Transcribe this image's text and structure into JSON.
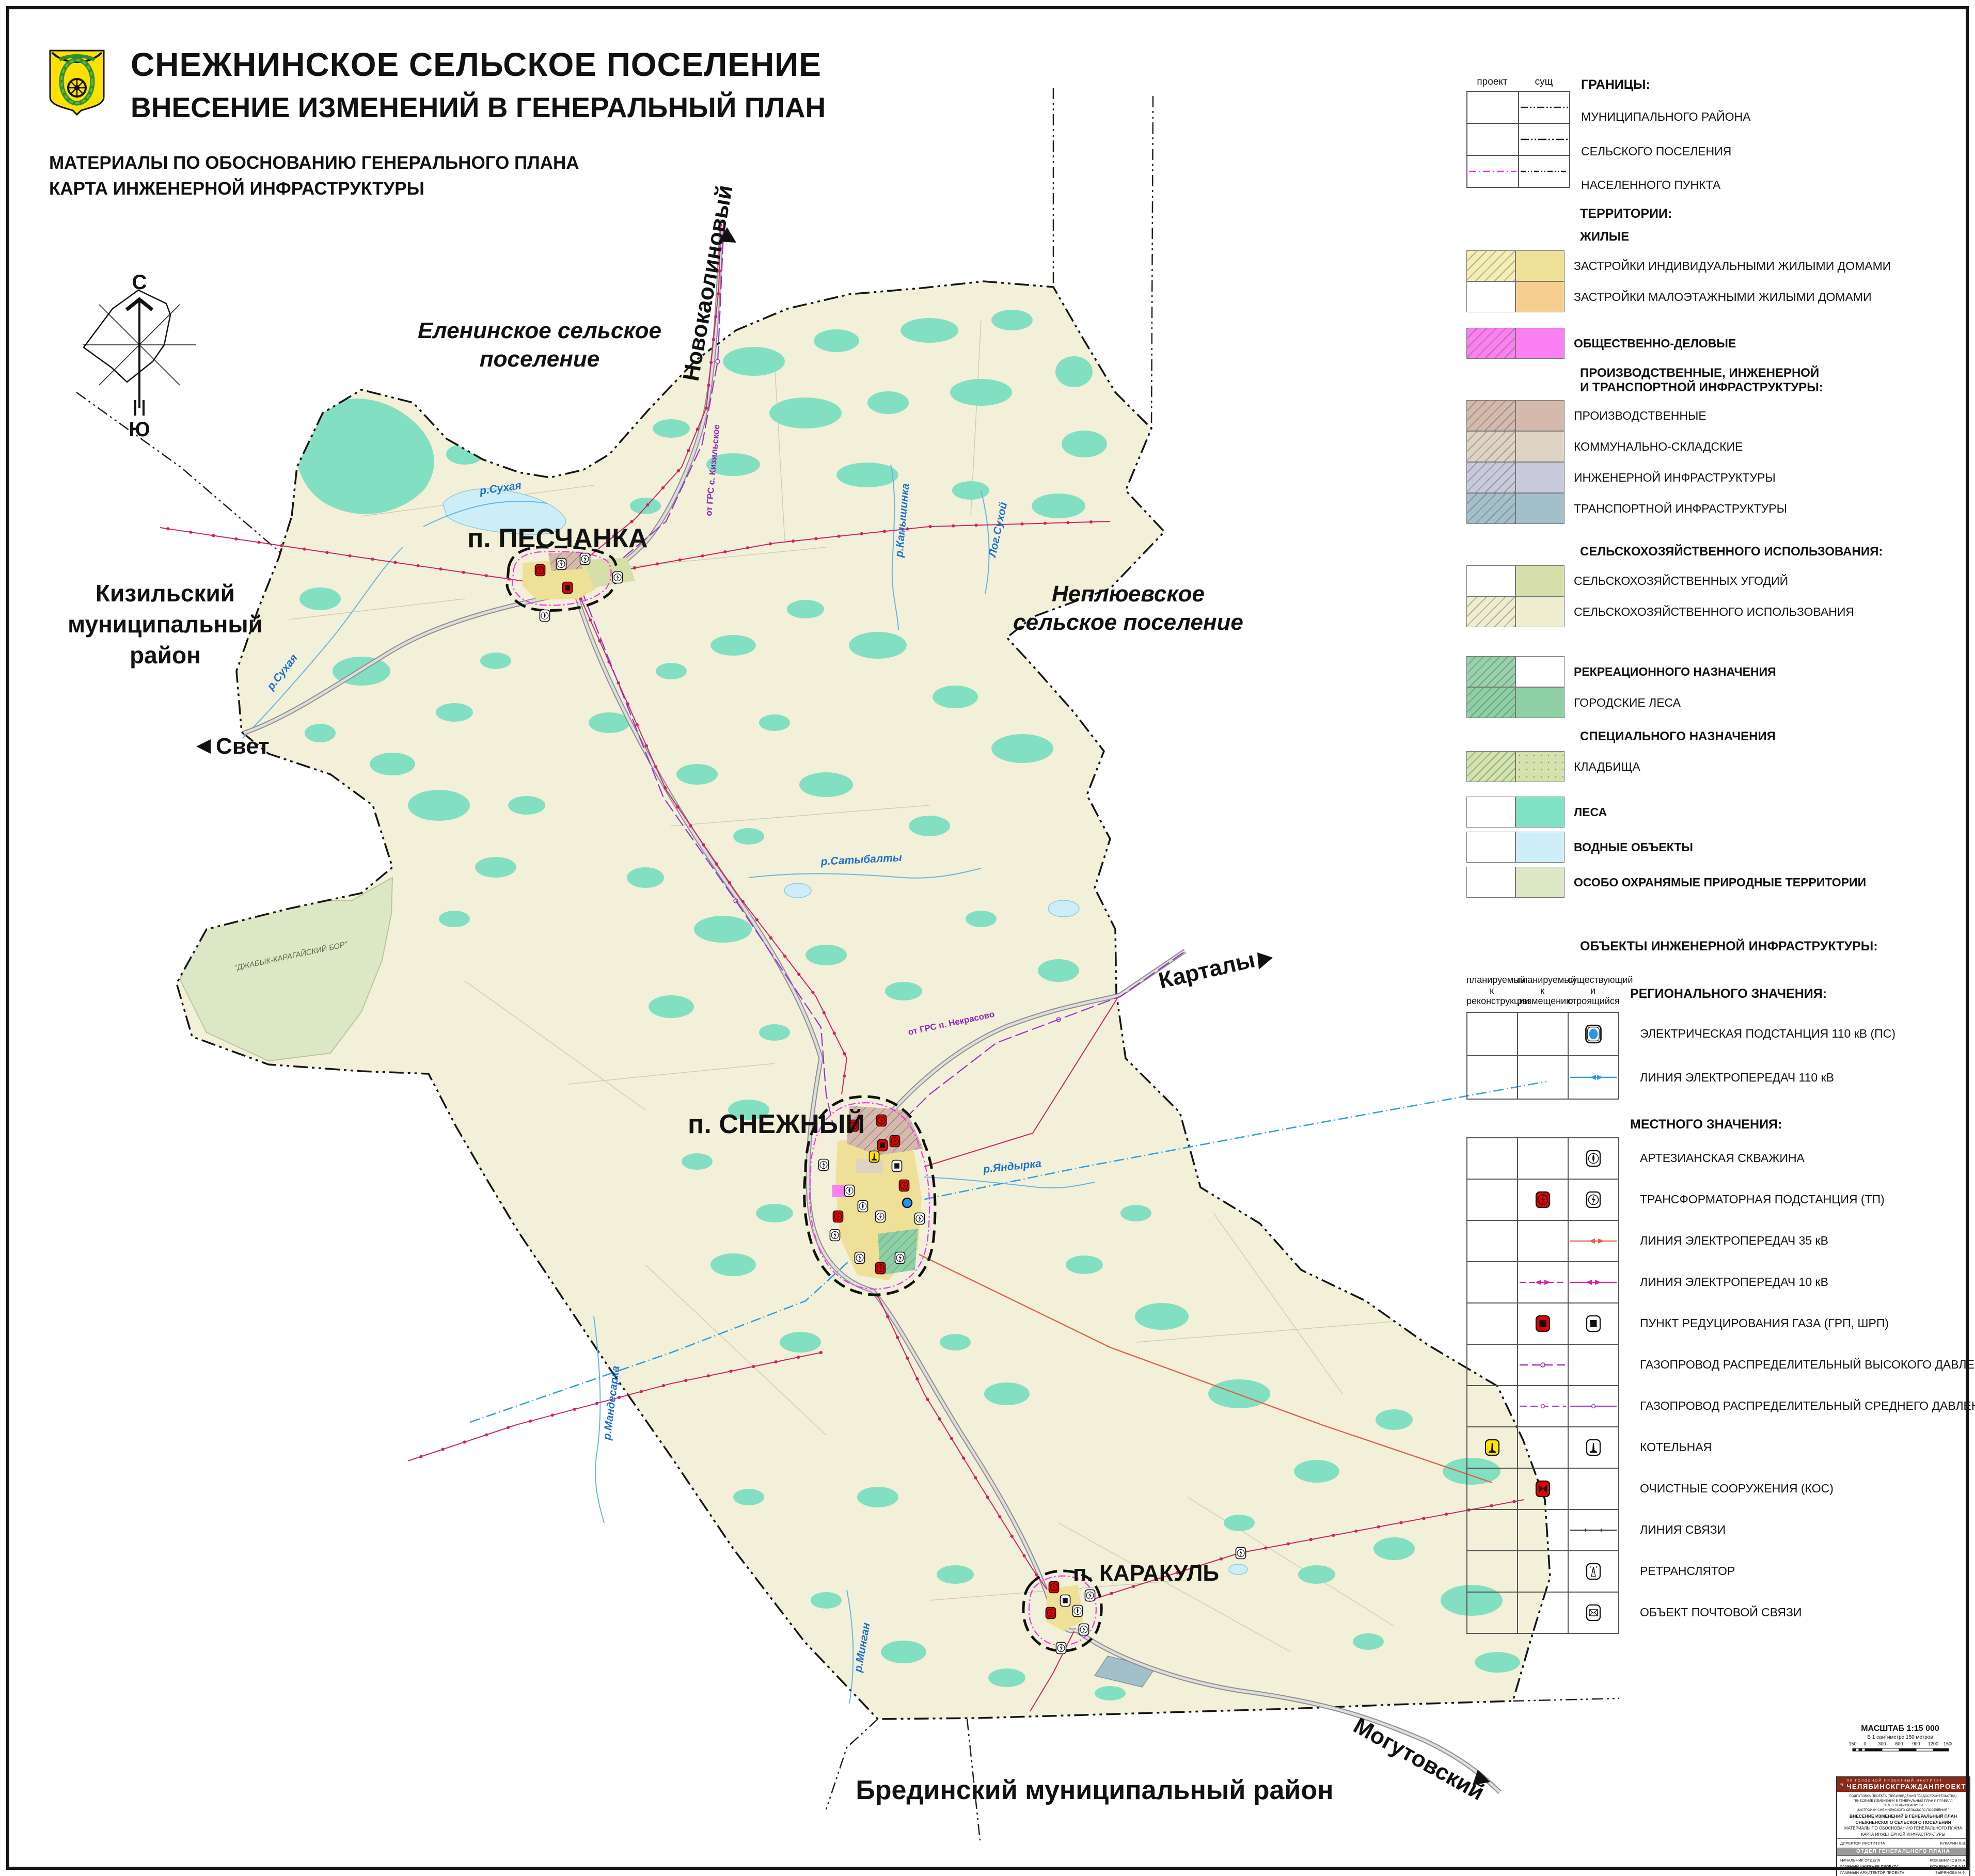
{
  "header": {
    "title1": "СНЕЖНИНСКОЕ СЕЛЬСКОЕ ПОСЕЛЕНИЕ",
    "title2": "ВНЕСЕНИЕ ИЗМЕНЕНИЙ В ГЕНЕРАЛЬНЫЙ ПЛАН",
    "sub1": "МАТЕРИАЛЫ ПО ОБОСНОВАНИЮ ГЕНЕРАЛЬНОГО ПЛАНА",
    "sub2": "КАРТА ИНЖЕНЕРНОЙ ИНФРАСТРУКТУРЫ"
  },
  "compass": {
    "n": "С",
    "s": "Ю"
  },
  "map": {
    "villages": {
      "peschanka": "п. ПЕСЧАНКА",
      "snezhny": "п. СНЕЖНЫЙ",
      "karakul": "п. КАРАКУЛЬ"
    },
    "neighbors": {
      "elenin1": "Еленинское сельское",
      "elenin2": "поселение",
      "neplyuev1": "Неплюевское",
      "neplyuev2": "сельское поселение",
      "kizil1": "Кизильский",
      "kizil2": "муниципальный",
      "kizil3": "район",
      "bredin": "Брединский муниципальный район"
    },
    "roads": {
      "novokaolinovy": "Новокаолиновый",
      "svet": "Свет",
      "kartaly": "Карталы",
      "mogutovsky": "Могутовский"
    },
    "rivers": {
      "sukhaya": "р.Сухая",
      "sukhaya2": "р.Сухая",
      "kamyshinka": "р.Камышинка",
      "logsukhoy": "Лог.Сухой",
      "satybalty": "р.Сатыбалты",
      "yandyrka": "р.Яндырка",
      "mandesarka": "р.Мандесарка",
      "mingan": "р.Минган"
    },
    "gas": {
      "kizil": "от ГРС с. Кизильское",
      "nekrasovo": "от ГРС п. Некрасово"
    },
    "protected": "\"ДЖАБЫК-КАРАГАЙСКИЙ БОР\""
  },
  "legend": {
    "borders": {
      "title": "ГРАНИЦЫ:",
      "col_project": "проект",
      "col_exist": "сущ",
      "r1": "МУНИЦИПАЛЬНОГО РАЙОНА",
      "r2": "СЕЛЬСКОГО ПОСЕЛЕНИЯ",
      "r3": "НАСЕЛЕННОГО ПУНКТА"
    },
    "territories": {
      "title": "ТЕРРИТОРИИ:",
      "zhilye": "ЖИЛЫЕ",
      "r_izhs": "ЗАСТРОЙКИ ИНДИВИДУАЛЬНЫМИ ЖИЛЫМИ ДОМАМИ",
      "r_mzhs": "ЗАСТРОЙКИ МАЛОЭТАЖНЫМИ ЖИЛЫМИ ДОМАМИ",
      "r_od": "ОБЩЕСТВЕННО-ДЕЛОВЫЕ",
      "prod1": "ПРОИЗВОДСТВЕННЫЕ, ИНЖЕНЕРНОЙ",
      "prod2": "И ТРАНСПОРТНОЙ ИНФРАСТРУКТУРЫ:",
      "r_prod": "ПРОИЗВОДСТВЕННЫЕ",
      "r_kommun": "КОММУНАЛЬНО-СКЛАДСКИЕ",
      "r_inzh": "ИНЖЕНЕРНОЙ ИНФРАСТРУКТУРЫ",
      "r_transp": "ТРАНСПОРТНОЙ ИНФРАСТРУКТУРЫ",
      "selhoz": "СЕЛЬСКОХОЗЯЙСТВЕННОГО ИСПОЛЬЗОВАНИЯ:",
      "r_ugod": "СЕЛЬСКОХОЗЯЙСТВЕННЫХ УГОДИЙ",
      "r_selhoz": "СЕЛЬСКОХОЗЯЙСТВЕННОГО ИСПОЛЬЗОВАНИЯ",
      "r_rekr": "РЕКРЕАЦИОННОГО НАЗНАЧЕНИЯ",
      "r_gorlesa": "ГОРОДСКИЕ ЛЕСА",
      "spec": "СПЕЦИАЛЬНОГО НАЗНАЧЕНИЯ",
      "r_kladb": "КЛАДБИЩА",
      "r_lesa": "ЛЕСА",
      "r_vodn": "ВОДНЫЕ ОБЪЕКТЫ",
      "r_oopt": "ОСОБО ОХРАНЯМЫЕ ПРИРОДНЫЕ ТЕРРИТОРИИ"
    },
    "objects": {
      "title": "ОБЪЕКТЫ ИНЖЕНЕРНОЙ ИНФРАСТРУКТУРЫ:",
      "col1": "планируемый к реконструкции",
      "col2": "планируемый к размещению",
      "col3": "существующий и строящийся",
      "regional": "РЕГИОНАЛЬНОГО ЗНАЧЕНИЯ:",
      "r_ps": "ЭЛЕКТРИЧЕСКАЯ ПОДСТАНЦИЯ 110 кВ (ПС)",
      "r_lep110": "ЛИНИЯ ЭЛЕКТРОПЕРЕДАЧ 110 кВ",
      "local": "МЕСТНОГО ЗНАЧЕНИЯ:",
      "r_well": "АРТЕЗИАНСКАЯ СКВАЖИНА",
      "r_tp": "ТРАНСФОРМАТОРНАЯ ПОДСТАНЦИЯ  (ТП)",
      "r_lep35": "ЛИНИЯ ЭЛЕКТРОПЕРЕДАЧ 35 кВ",
      "r_lep10": "ЛИНИЯ ЭЛЕКТРОПЕРЕДАЧ 10 кВ",
      "r_grp": "ПУНКТ РЕДУЦИРОВАНИЯ ГАЗА (ГРП, ШРП)",
      "r_gas_high": "ГАЗОПРОВОД РАСПРЕДЕЛИТЕЛЬНЫЙ ВЫСОКОГО ДАВЛЕНИЯ",
      "r_gas_mid": "ГАЗОПРОВОД РАСПРЕДЕЛИТЕЛЬНЫЙ СРЕДНЕГО ДАВЛЕНИЯ",
      "r_boiler": "КОТЕЛЬНАЯ",
      "r_kos": "ОЧИСТНЫЕ СООРУЖЕНИЯ (КОС)",
      "r_svyaz": "ЛИНИЯ СВЯЗИ",
      "r_retr": "РЕТРАНСЛЯТОР",
      "r_post": "ОБЪЕКТ ПОЧТОВОЙ СВЯЗИ"
    }
  },
  "scalebar": {
    "title": "МАСШТАБ 1:15 000",
    "subtitle": "В 1 сантиметре 150 метров",
    "ticks": [
      "150",
      "0",
      "300",
      "600",
      "900",
      "1200",
      "1500"
    ]
  },
  "stamp": {
    "org1": "ПК ГОЛОВНОЙ ПРОЕКТНЫЙ ИНСТИТУТ",
    "org2": "ЧЕЛЯБИНСКГРАЖДАНПРОЕКТ",
    "p1": "ПОДГОТОВКА ПРОЕКТА (ПРОИЗВЕДЕНИЯ ГРАДОСТРОИТЕЛЬСТВА):",
    "p2": "\"ВНЕСЕНИЕ ИЗМЕНЕНИЙ В ГЕНЕРАЛЬНЫЙ ПЛАН И ПРАВИЛА ЗЕМЛЕПОЛЬЗОВАНИЯ И",
    "p3": "ЗАСТРОЙКИ СНЕЖНЕНСКОГО СЕЛЬСКОГО ПОСЕЛЕНИЯ \"",
    "d1": "ВНЕСЕНИЕ ИЗМЕНЕНИЙ В ГЕНЕРАЛЬНЫЙ ПЛАН",
    "d2": "СНЕЖНЕНСКОГО СЕЛЬСКОГО ПОСЕЛЕНИЯ",
    "d3": "МАТЕРИАЛЫ ПО ОБОСНОВАНИЮ ГЕНЕРАЛЬНОГО ПЛАНА",
    "d4": "КАРТА ИНЖЕНЕРНОЙ ИНФРАСТРУКТУРЫ",
    "dir_label": "ДИРЕКТОР ИНСТИТУТА",
    "dir_name": "КУКАРИН В.В.",
    "dept": "ОТДЕЛ ГЕНЕРАЛЬНОГО ПЛАНА",
    "roles": [
      {
        "label": "НАЧАЛЬНИК ОТДЕЛА",
        "name": "КОЖЕВНИКОВ М.А."
      },
      {
        "label": "ГЛАВНЫЙ ИНЖЕНЕР ПРОЕКТА",
        "name": "КОЖЕВНИКОВ А.М."
      },
      {
        "label": "ГЛАВНЫЙ АРХИТЕКТОР ПРОЕКТА",
        "name": "ЗЫРЯНОВА Н.Ф."
      },
      {
        "label": "ИНЖЕНЕР",
        "name": "ШИШОВ М.В."
      },
      {
        "label": "ИНЖЕНЕР",
        "name": "ПОПОВ А.Е."
      }
    ],
    "code": "ШИФР  137-19-11",
    "city": "ЧЕЛЯБИНСК",
    "year": "2019"
  },
  "colors": {
    "terrain": "#f2f0d8",
    "forest": "#82dfc2",
    "water": "#cdeef6",
    "izhs": "#efe098",
    "izhs_p": "#f4edb4",
    "mzhs": "#f6cf90",
    "od": "#fa7ff0",
    "prod": "#d4b9ac",
    "kommun": "#ded3c3",
    "inzh": "#c9c9dc",
    "transp": "#a2bfca",
    "ugod": "#d6dfaa",
    "selhoz": "#efedcf",
    "rekr": "#9ad1ad",
    "gorles": "#8fcfa6",
    "kladb": "#d5e2ae",
    "lesa": "#7fe2c4",
    "vodn": "#cdeef6",
    "oopt": "#dce7c6",
    "line110": "#2e9fe6",
    "line35": "#e2604e",
    "line10": "#e01fa8",
    "gas": "#9a30c8",
    "crimson": "#cf2468",
    "road": "#9a9a9a",
    "stamp": "#8a2b18",
    "np": "#f531f5"
  }
}
